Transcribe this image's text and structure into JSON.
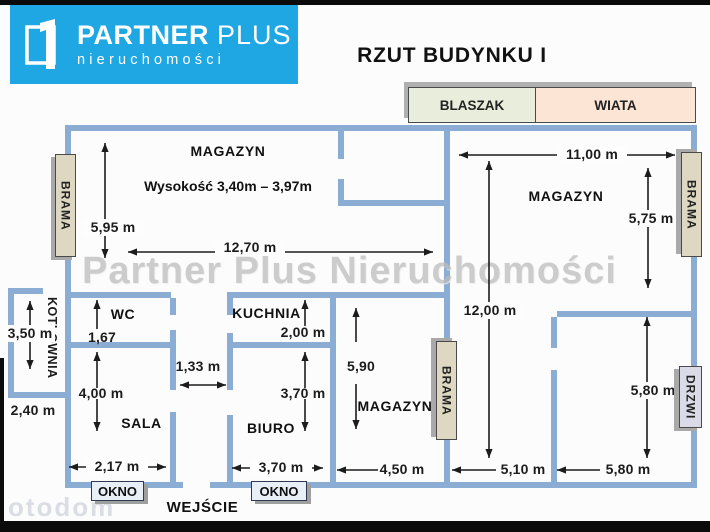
{
  "page": {
    "title": "RZUT  BUDYNKU I"
  },
  "logo": {
    "brand_bold": "PARTNER",
    "brand_light": "PLUS",
    "subtitle": "nieruchomości"
  },
  "legend": {
    "blaszak": "BLASZAK",
    "wiata": "WIATA"
  },
  "rooms": {
    "magazyn_top_left": "MAGAZYN",
    "height_note": "Wysokość 3,40m – 3,97m",
    "magazyn_top_right": "MAGAZYN",
    "wc": "WC",
    "kuchnia": "KUCHNIA",
    "kotlownia": "KOTŁOWNIA",
    "sala": "SALA",
    "biuro": "BIURO",
    "magazyn_bottom": "MAGAZYN",
    "wejscie": "WEJŚCIE"
  },
  "openings": {
    "brama_left": "BRAMA",
    "brama_middle": "BRAMA",
    "brama_right": "BRAMA",
    "drzwi": "DRZWI",
    "okno_left": "OKNO",
    "okno_right": "OKNO"
  },
  "dimensions": {
    "magazyn_tl_height": "5,95 m",
    "magazyn_tl_width": "12,70 m",
    "magazyn_tr_width": "11,00 m",
    "magazyn_tr_height": "5,75 m",
    "right_section_height": "12,00 m",
    "kotlownia_height": "3,50 m",
    "kotlownia_width": "2,40 m",
    "wc_depth": "1,67",
    "kuchnia_depth": "2,00 m",
    "corridor_width": "1,33 m",
    "sala_height": "4,00 m",
    "sala_width": "2,17 m",
    "biuro_height": "3,70 m",
    "biuro_width": "3,70 m",
    "magazyn_bottom_height": "5,90",
    "magazyn_bottom_width": "4,50 m",
    "middle_bottom_width": "5,10 m",
    "right_room_height": "5,80 m",
    "right_room_width": "5,80 m"
  },
  "watermarks": {
    "center": "Partner Plus Nieruchomości",
    "portal": "otodom"
  },
  "colors": {
    "wall": "#8cadd3",
    "logo_blue": "#1ea7e2",
    "brama_fill": "#ded8c2",
    "drzwi_fill": "#dbdbe7",
    "okno_fill": "#e9eff6",
    "blaszak_fill": "#e9eedc",
    "wiata_fill": "#fce5d4"
  }
}
